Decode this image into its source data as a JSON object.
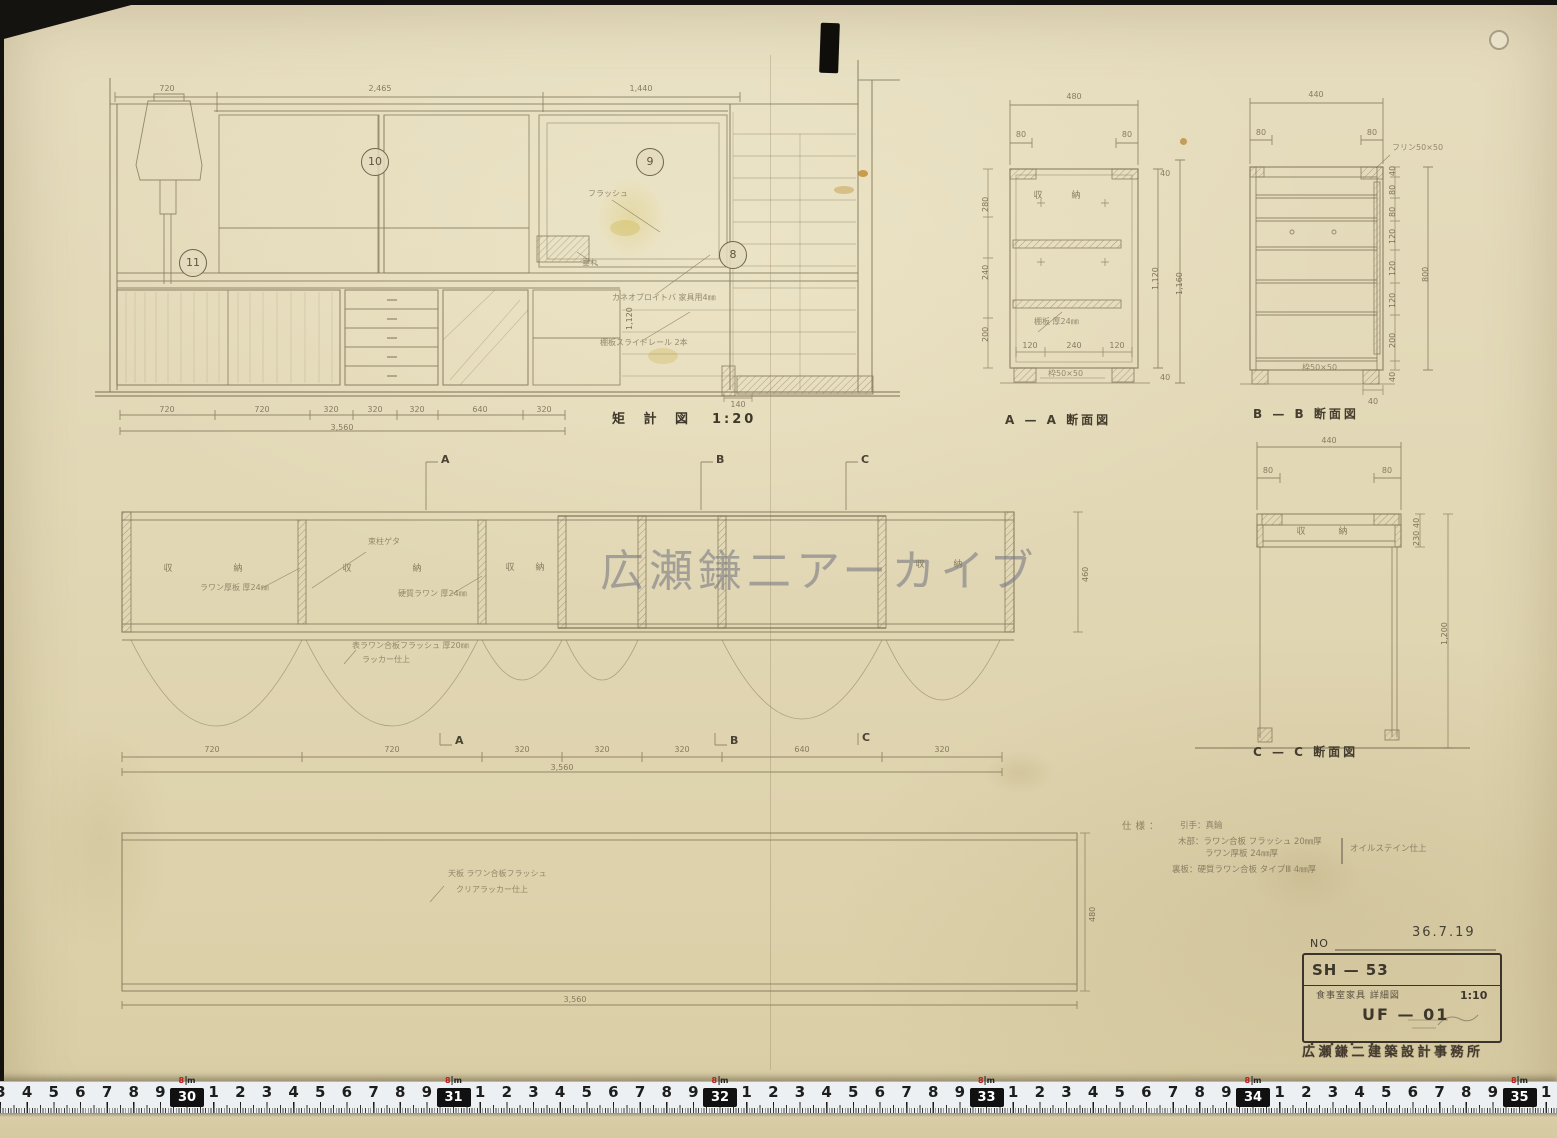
{
  "watermark": "広瀬鎌二アーカイブ",
  "labels": {
    "main": "矩 計 図",
    "main_scale": "1:20",
    "aa": "A — A 断面図",
    "bb": "B — B 断面図",
    "cc": "C — C 断面図"
  },
  "elevation": {
    "top_dims": [
      "720",
      "2,465",
      "1,440"
    ],
    "bottom_dims": [
      "720",
      "720",
      "320",
      "320",
      "320",
      "640",
      "320"
    ],
    "total": "3,560",
    "small_dim": "140",
    "side_dim": "1,120",
    "balloons": {
      "b10": "10",
      "b9": "9",
      "b11": "11",
      "b8": "8"
    },
    "notes": [
      "フラッシュ",
      "カネオブロイトバ 家具用4㎜",
      "棚板スライドレール 2本",
      "垂れ"
    ]
  },
  "plan": {
    "markers": [
      "A",
      "B",
      "C"
    ],
    "storage": "収　納",
    "notes": [
      "束柱ゲタ",
      "ラワン厚板 厚24㎜",
      "硬質ラワン 厚24㎜",
      "表ラワン合板フラッシュ 厚20㎜",
      "ラッカー仕上"
    ],
    "side_dim": "460",
    "bottom_dims": [
      "720",
      "720",
      "320",
      "320",
      "320",
      "640",
      "320"
    ],
    "total": "3,560"
  },
  "bottom_panel": {
    "notes": [
      "天板 ラワン合板フラッシュ",
      "クリアラッカー仕上"
    ],
    "side_dim": "480",
    "total": "3,560"
  },
  "section_aa": {
    "top_dim": "480",
    "edge_dims": [
      "80",
      "80"
    ],
    "storage": "収　納",
    "shelf_note": "棚板 厚24㎜",
    "bottom_dims": [
      "120",
      "240",
      "120"
    ],
    "frame_note": "枠50×50",
    "right_dims": [
      "1,120",
      "1,160"
    ],
    "left_dims": [
      "280",
      "240",
      "200"
    ],
    "small_dims": [
      "40",
      "40"
    ]
  },
  "section_bb": {
    "top_dim": "440",
    "edge_dims": [
      "80",
      "80"
    ],
    "top_note": "フリン50×50",
    "right_dims": [
      "40",
      "80",
      "80",
      "120",
      "120",
      "120",
      "200",
      "40"
    ],
    "long_dim": "800",
    "frame_note": "枠50×50",
    "small_dim": "40"
  },
  "section_cc": {
    "top_dim": "440",
    "edge_dims": [
      "80",
      "80"
    ],
    "storage": "収　納",
    "right_dims": [
      "40",
      "230"
    ],
    "long_dim": "1,200"
  },
  "specs": {
    "title": "仕様：",
    "line1": "引手：真鍮",
    "line2": "木部：ラワン合板 フラッシュ 20㎜厚",
    "line3": "ラワン厚板 24㎜厚",
    "brace_note": "オイルステイン仕上",
    "line4": "裏板：硬質ラワン合板 タイプⅢ 4㎜厚"
  },
  "title_block": {
    "no_label": "NO",
    "date": "36.7.19",
    "code": "SH — 53",
    "desc": "食事室家具 詳細図",
    "scale": "1:10",
    "number": "UF — 01",
    "stamp": "広瀬鎌二建築設計事務所"
  },
  "ruler": {
    "red_label": "8",
    "red_unit": "m",
    "origin_px": 187,
    "unit_px": 26.65,
    "origin_value_cm": 300,
    "decades": [
      "30",
      "40",
      "50",
      "60",
      "70",
      "80"
    ]
  }
}
